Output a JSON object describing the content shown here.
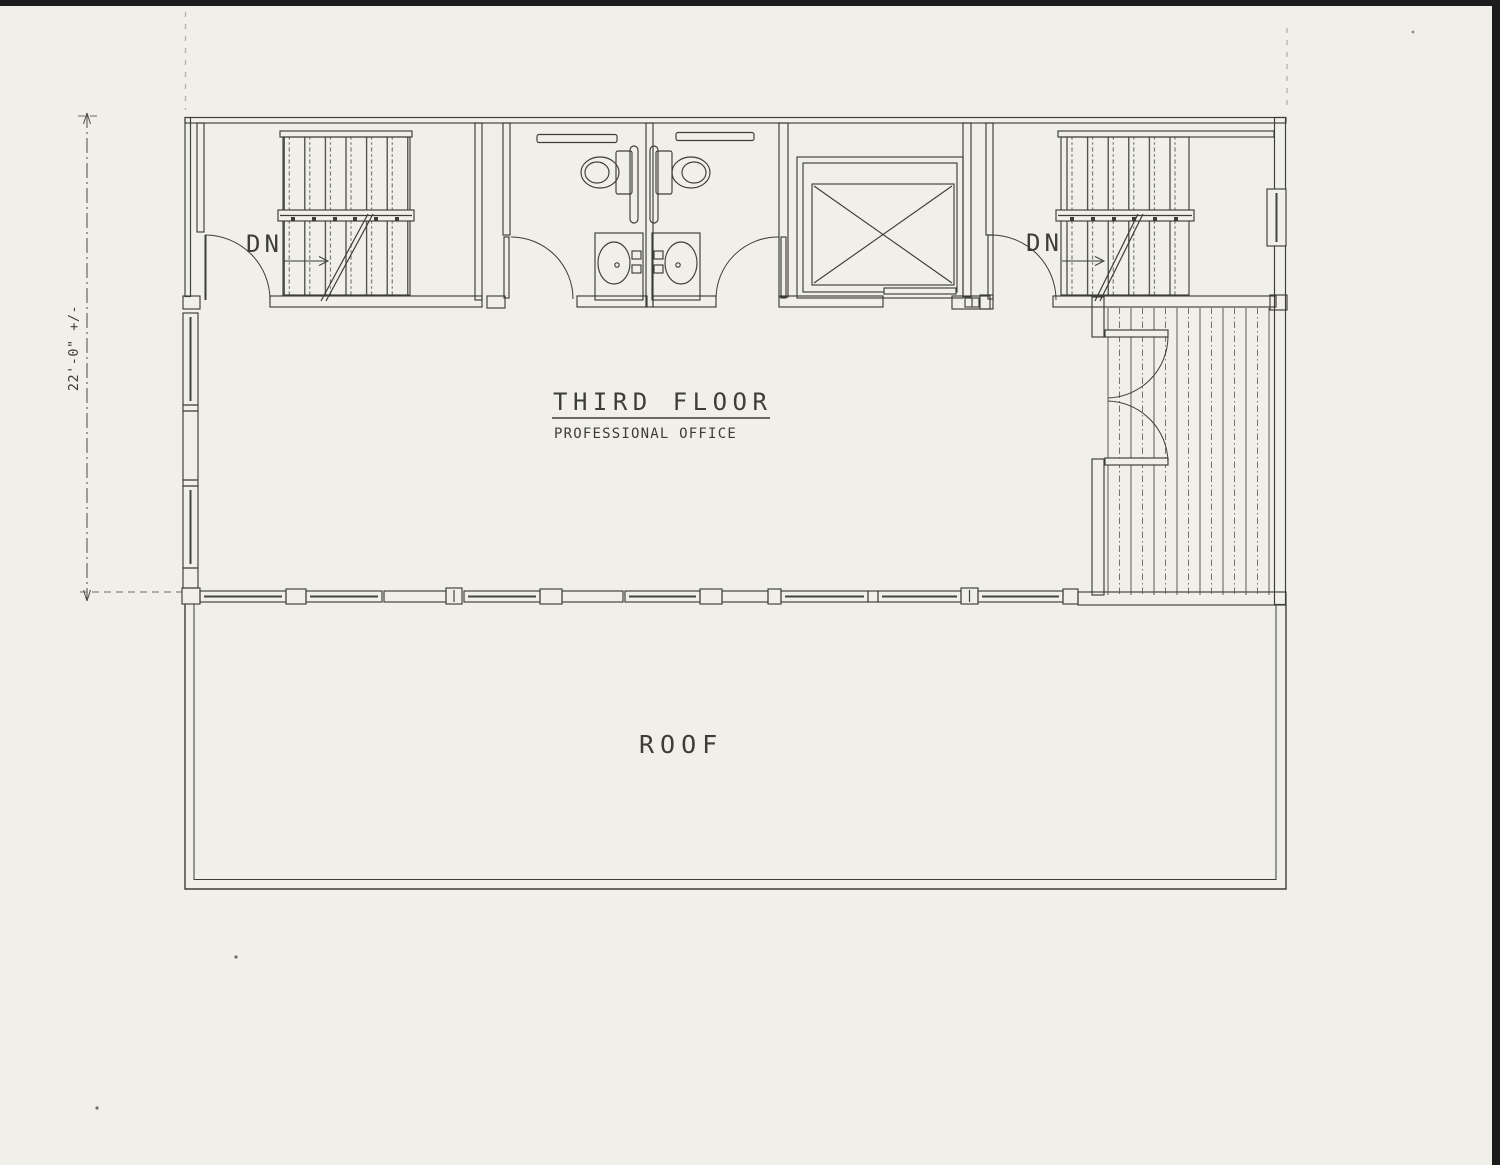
{
  "annotations": {
    "title": "THIRD FLOOR",
    "subtitle": "PROFESSIONAL OFFICE",
    "roof_label": "ROOF",
    "stair_left_label": "DN",
    "stair_right_label": "DN",
    "dimension_west": "22'-0\" +/-"
  },
  "palette": {
    "paper": "#f0efe9",
    "ink": "#3d3c37",
    "ink_light": "#6b6963",
    "glass_line": "#45443f",
    "scan_edge": "#1c1c1c",
    "fold_line": "#b8b5ac"
  }
}
